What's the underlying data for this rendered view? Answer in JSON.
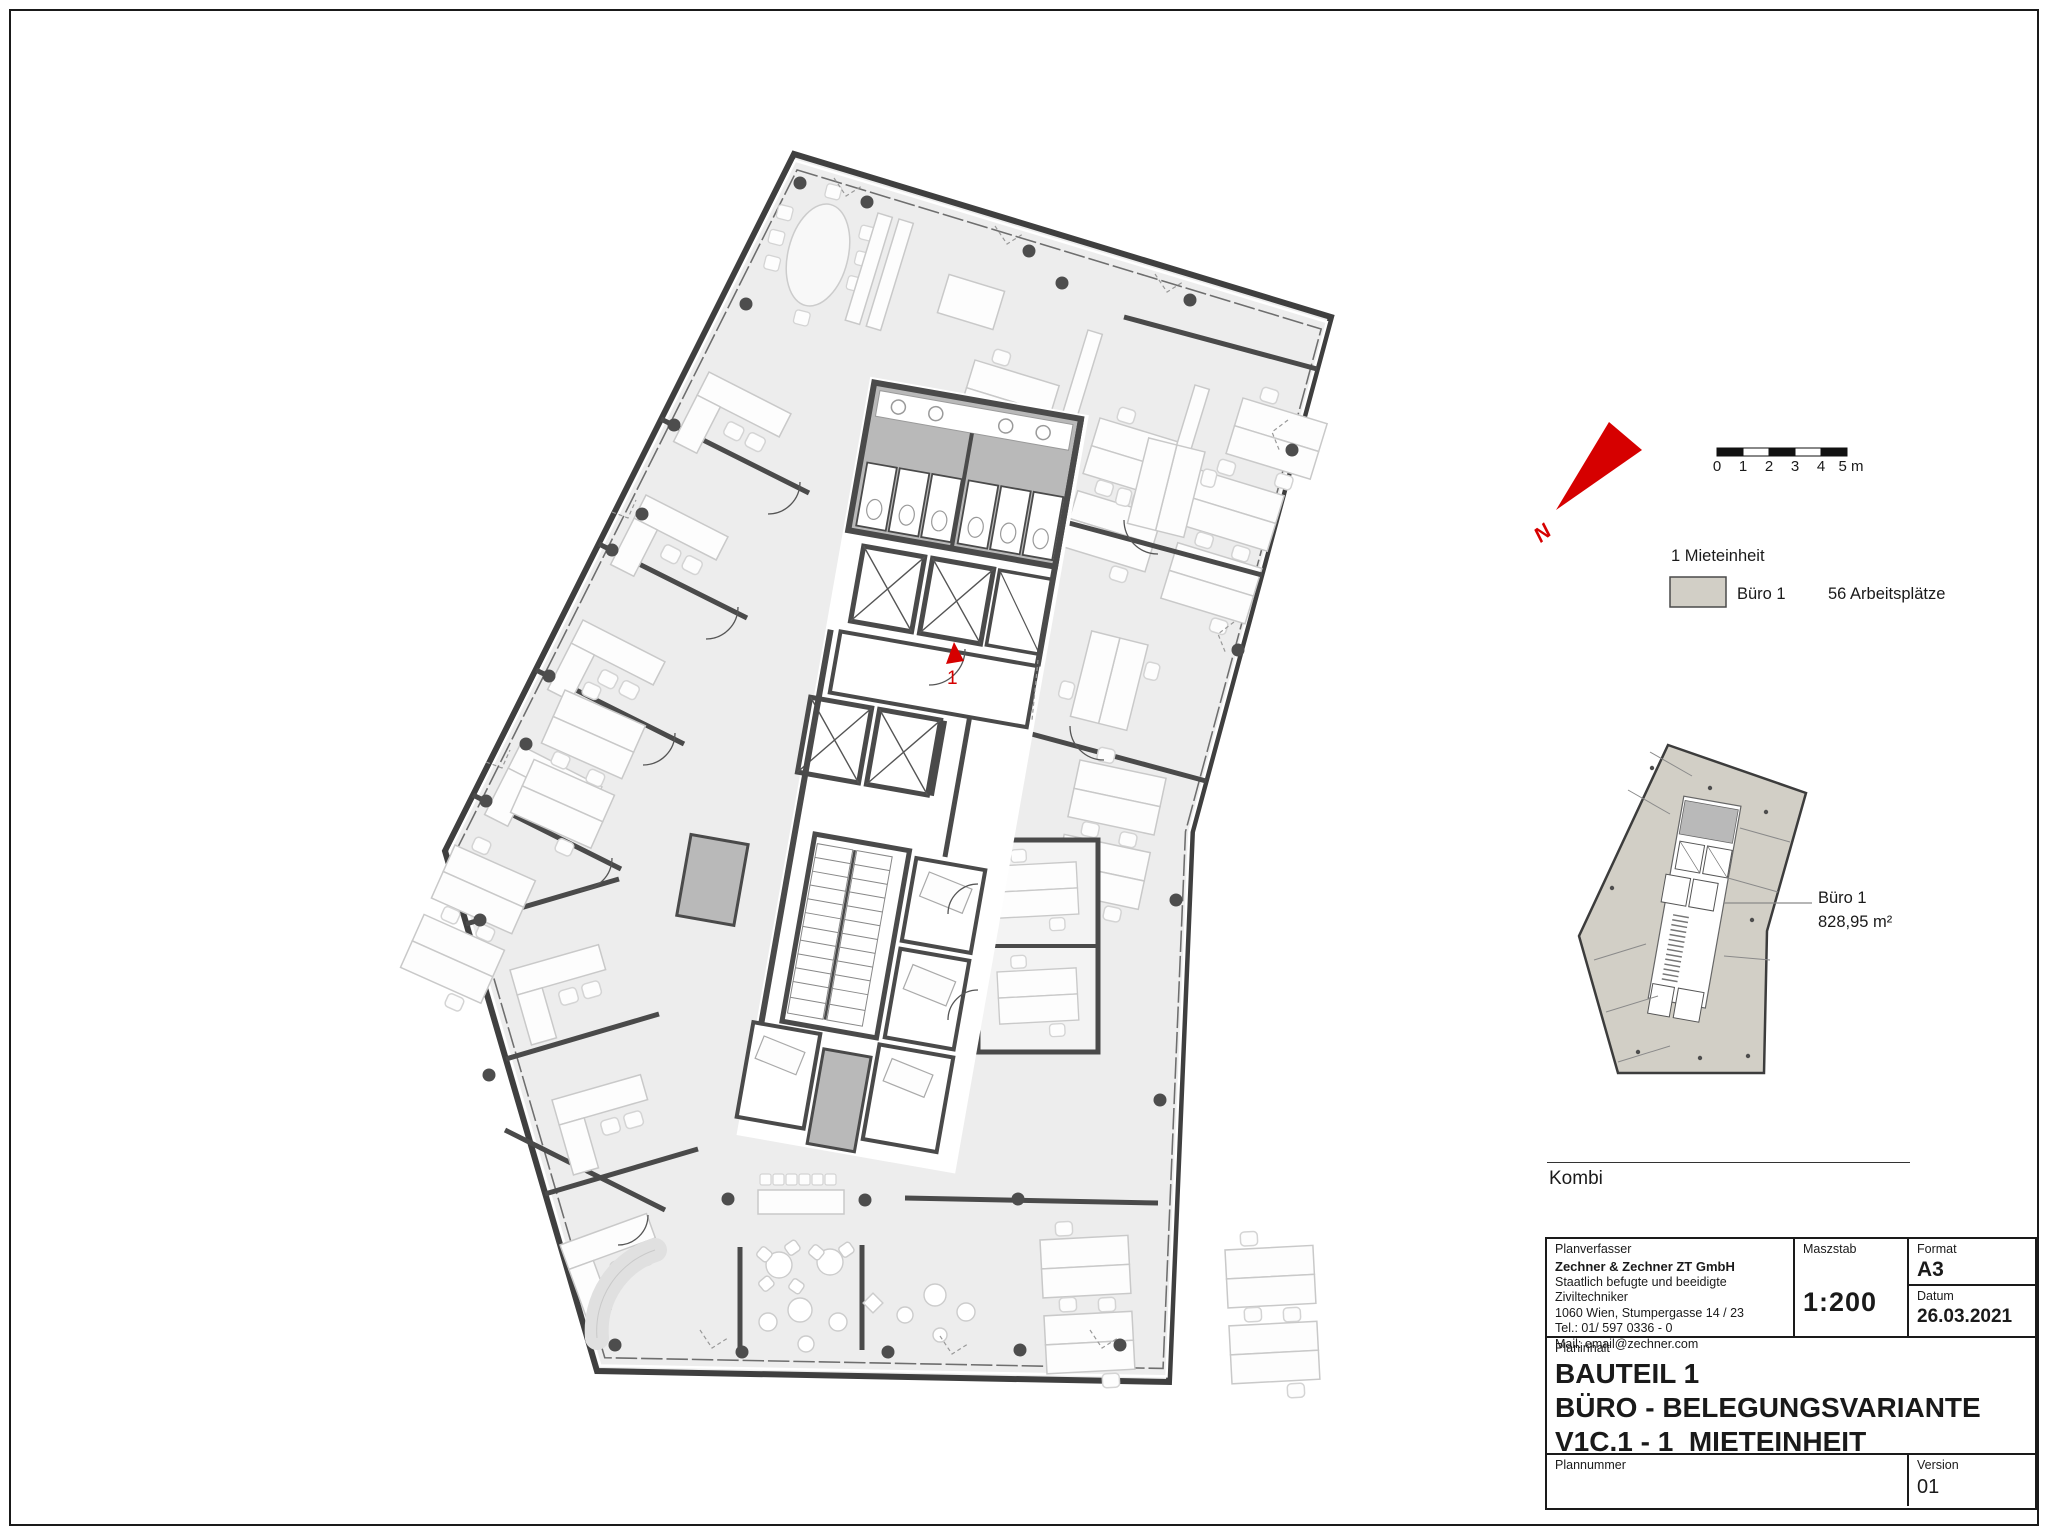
{
  "sheet": {
    "section_label": "Kombi",
    "plan_marker": "1",
    "north_label": "N"
  },
  "scalebar": {
    "labels": [
      "0",
      "1",
      "2",
      "3",
      "4",
      "5 m"
    ]
  },
  "legend": {
    "title": "1 Mieteinheit",
    "unit_label": "Büro 1",
    "workplaces": "56 Arbeitsplätze"
  },
  "overview": {
    "room_label": "Büro 1",
    "area": "828,95 m²"
  },
  "titleblock": {
    "planverfasser_label": "Planverfasser",
    "company": "Zechner & Zechner ZT GmbH",
    "company_line2": "Staatlich befugte und beeidigte Ziviltechniker",
    "address": "1060 Wien, Stumpergasse 14 / 23",
    "tel": "Tel.: 01/ 597 0336 - 0",
    "mail": "Mail: email@zechner.com",
    "maszstab_label": "Maszstab",
    "maszstab_value": "1:200",
    "format_label": "Format",
    "format_value": "A3",
    "datum_label": "Datum",
    "datum_value": "26.03.2021",
    "planinhalt_label": "Planinhalt",
    "title_line1": "BAUTEIL 1",
    "title_line2": "BÜRO - BELEGUNGSVARIANTE",
    "title_line3": "V1C.1 - 1  MIETEINHEIT",
    "plannummer_label": "Plannummer",
    "version_label": "Version",
    "version_value": "01"
  },
  "colors": {
    "accent_red": "#d60000",
    "unit_fill": "#d2cfc6",
    "wall": "#4a4a4a",
    "wc_gray": "#b9b9b9",
    "floor": "#ededed"
  }
}
